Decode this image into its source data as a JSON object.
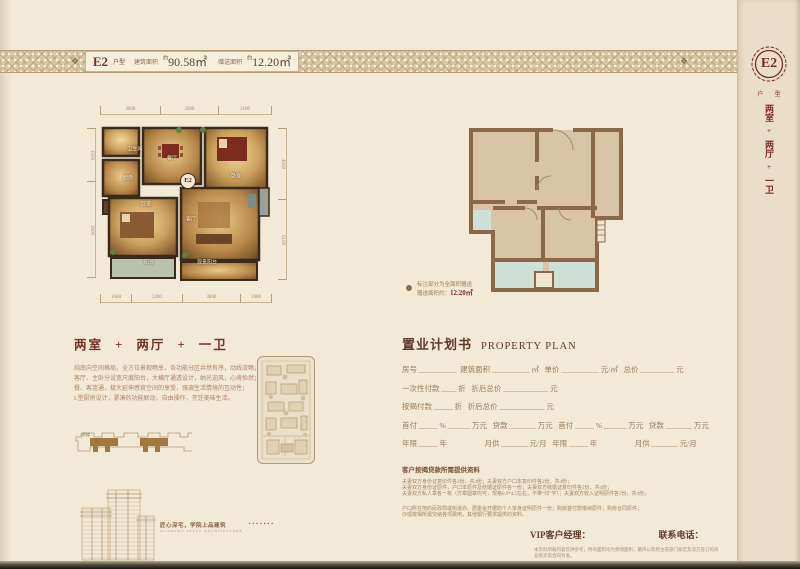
{
  "header": {
    "unit": "E2",
    "unit_suffix": "户型",
    "area1_label": "建筑面积",
    "approx": "约",
    "area1_value": "90.58㎡",
    "area2_label": "赠送面积",
    "area2_value": "12.20㎡"
  },
  "sidebar": {
    "seal": "E2",
    "seal_sub": "户 型",
    "layout_vertical": [
      "两室",
      "+",
      "两厅",
      "+",
      "一卫"
    ]
  },
  "floorplan": {
    "badge": "E2",
    "rooms": [
      "卫生间",
      "厨房",
      "餐厅",
      "卧室",
      "卧室",
      "客厅",
      "阳台",
      "观景阳台"
    ],
    "dims_top": [
      "3600",
      "3500",
      "3100"
    ],
    "dims_bottom": [
      "1600",
      "3200",
      "3800",
      "1600"
    ],
    "dims_left": [
      "1500",
      "3000"
    ],
    "dims_right": [
      "4500",
      "5100"
    ]
  },
  "outline": {
    "note_line1": "标注部分为全面积赠送",
    "note_line2_label": "赠送面积约：",
    "note_line2_value": "12.20㎡"
  },
  "left_section": {
    "heading": "两室 + 两厅 + 一卫",
    "paragraph": [
      "纯南向空间格局，全方位景观畅享，各功能分区井然有序，动线流畅；",
      "客厅、主卧分设宽尺度阳台，大横厅通透设计，纳光迎风，心境怡然；",
      "餐、客连通，极大延伸感官空间的享受，强调生活情境的互动性；",
      "L型厨房设计，紧凑的功能联动，自由操作，烹饪美味生活。"
    ]
  },
  "bottom_left": {
    "plate_label": "1号楼",
    "caption_cn": "匠心深宅，学院上品建筑",
    "caption_en": "ACADEMY STYLE ARCHITECTURE",
    "stamps": "▪▪▪▪▪▪▪"
  },
  "plan_form": {
    "title_cn": "置业计划书",
    "title_en": "PROPERTY PLAN",
    "rows": [
      "房号 __________  建筑面积 __________ ㎡   单价 __________ 元/㎡   总价 _________ 元",
      "一次性付款 ____ 折   折后总价 ____________ 元",
      "按揭付款 _____ 折   折后总价 ____________ 元",
      "首付 _____ % ______ 万元   贷款 _______ 万元   首付 _____ % ______ 万元   贷款 _______ 万元",
      "年限 _____ 年                    月供 _______ 元/月   年限 _____ 年                    月供 _______ 元/月"
    ],
    "docs_title": "客户按揭贷款所需提供资料",
    "docs_lines": [
      "夫妻双方身份证复印件各2份，共4份；夫妻双方户口本复印件各2份，共4份；",
      "夫妻双方身份证原件，户口本原件及结婚证原件各一份；夫妻双方结婚证复印件各2份，共4份；",
      "夫妻双方私人章各一枚（方章圆章均可，规格0.9*4.5左右，不带“印”字）；夫妻双方收入证明原件各2份，共4份；"
    ],
    "docs_lines2": [
      "户口所在地的民政局或街道办、居委会开据的个人单身证明原件一份；购房首付款缴纳原件；购房合同原件；",
      "办理按揭所需交纳各项费用，其他银行要求提供的资料。"
    ],
    "vip_label": "VIP客户经理：",
    "phone_label": "联系电话：",
    "fine_print": "本资料所载内容仅供参考，所有面积均为预测面积，最终以政府主管部门核定及双方签订的商品房买卖合同为准。"
  }
}
